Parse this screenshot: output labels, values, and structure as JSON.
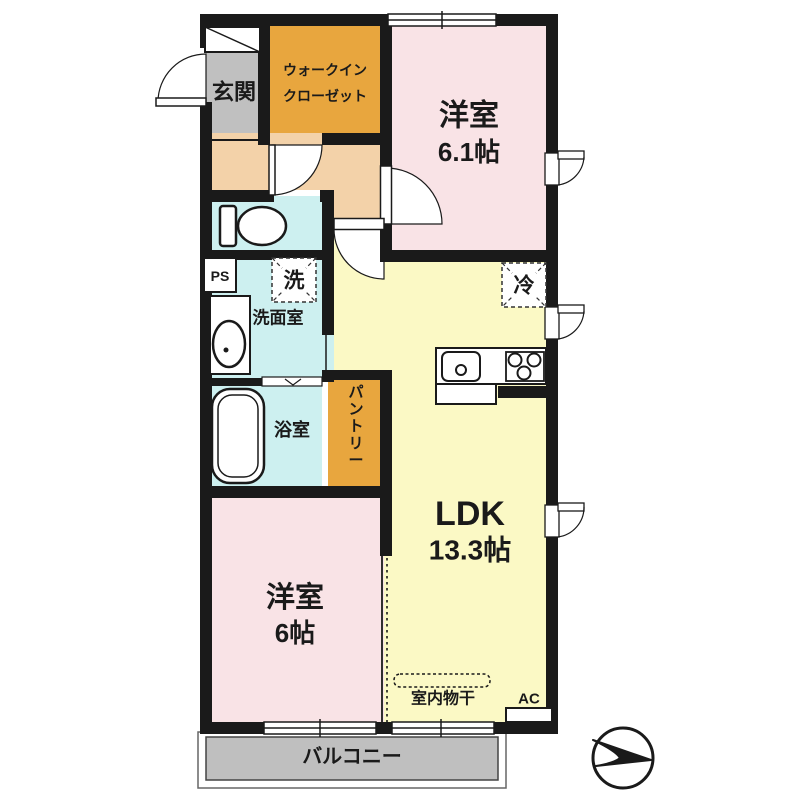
{
  "floorplan": {
    "rooms": {
      "entrance": {
        "label": "玄関"
      },
      "walk_in_closet": {
        "line1": "ウォークイン",
        "line2": "クローゼット"
      },
      "bedroom_1": {
        "label": "洋室",
        "size": "6.1帖"
      },
      "washroom": {
        "label": "洗面室"
      },
      "bathroom": {
        "label": "浴室"
      },
      "pantry": {
        "label": "パントリー"
      },
      "ldk": {
        "label": "LDK",
        "size": "13.3帖"
      },
      "bedroom_2": {
        "label": "洋室",
        "size": "6帖"
      },
      "balcony": {
        "label": "バルコニー"
      }
    },
    "annotations": {
      "pipe_space": "PS",
      "washer": "洗",
      "refrigerator": "冷",
      "indoor_drying": "室内物干",
      "air_conditioner": "AC"
    },
    "colors": {
      "wall": "#1a1a1a",
      "bedroom_pink": "#f9e3e6",
      "ldk_yellow": "#fbf9c5",
      "hall_peach": "#f3d2a9",
      "wet_area_blue": "#cdf0f0",
      "closet_orange": "#e8a63e",
      "entrance_gray": "#c0c0c0",
      "balcony_gray": "#bfbfbf"
    }
  }
}
